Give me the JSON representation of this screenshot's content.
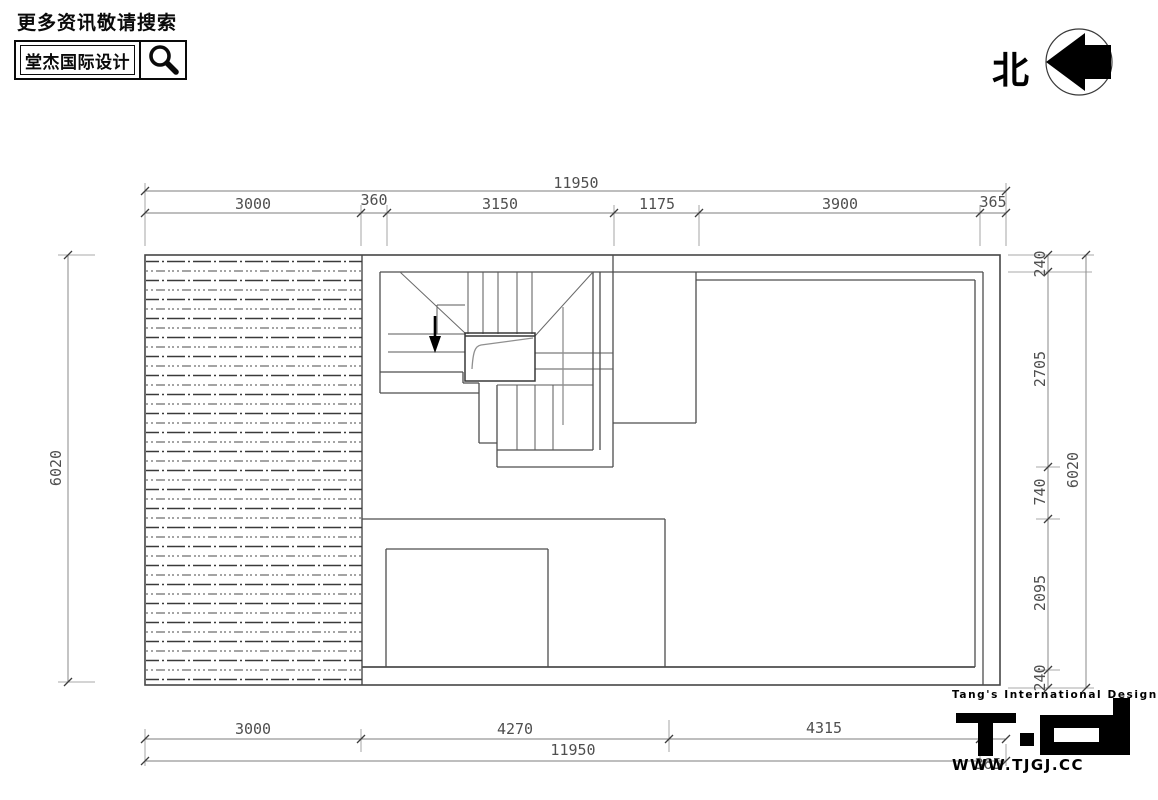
{
  "header": {
    "tagline": "更多资讯敬请搜索",
    "brand": "堂杰国际设计",
    "search_icon": "magnifier"
  },
  "north_indicator": {
    "label": "北",
    "arrow_direction": "left"
  },
  "dimensions": {
    "top": {
      "overall": "11950",
      "segments": [
        "3000",
        "360",
        "3150",
        "1175",
        "3900",
        "365"
      ]
    },
    "bottom": {
      "overall": "11950",
      "segments": [
        "3000",
        "4270",
        "4315",
        "365"
      ]
    },
    "left": {
      "overall": "6020"
    },
    "right": {
      "overall": "6020",
      "segments": [
        "240",
        "2705",
        "740",
        "2095",
        "240"
      ]
    }
  },
  "footer_logo": {
    "line1": "Tang's International Design",
    "monogram": "TID",
    "website": "WWW.TJGJ.CC"
  },
  "colors": {
    "wall": "#4d4d4d",
    "dim_line": "#7d7d7d",
    "ink": "#000000",
    "hatch_dark": "#3a3a3a",
    "hatch_light": "#6e6e6e"
  }
}
